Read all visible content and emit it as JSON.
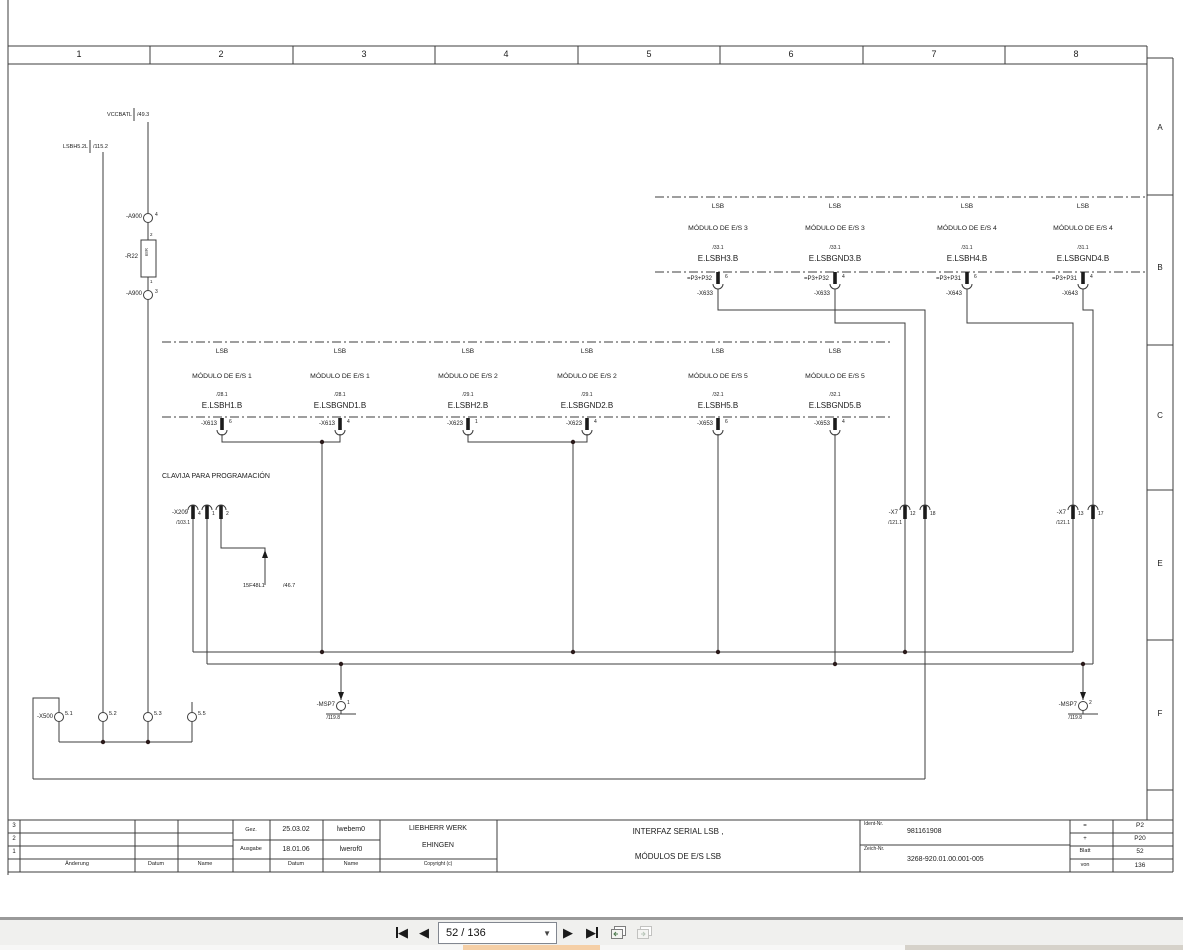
{
  "border": {
    "columns": [
      "1",
      "2",
      "3",
      "4",
      "5",
      "6",
      "7",
      "8"
    ],
    "rows": [
      "A",
      "B",
      "C",
      "E",
      "F"
    ]
  },
  "signals": {
    "vccbatl": {
      "name": "VCCBATL",
      "ref": "/49.3"
    },
    "lsbh52l": {
      "name": "LSBH5.2L",
      "ref": "/115.2"
    },
    "prog_ref": {
      "name": "15F48L1",
      "ref": "/46.7"
    }
  },
  "components": {
    "clavija_title": "CLAVIJA PARA PROGRAMACIÓN",
    "a900_top": {
      "label": "-A900",
      "pin": "4"
    },
    "a900_bottom": {
      "label": "-A900",
      "pin": "3"
    },
    "r22": {
      "label": "-R22",
      "value": "68R",
      "pin_top": "2",
      "pin_bottom": "1"
    },
    "x209": {
      "label": "-X209",
      "ref": "/103.1",
      "pins": [
        "4",
        "1",
        "2"
      ]
    },
    "x7_left": {
      "label": "-X7",
      "ref": "/121.1",
      "pins": [
        "12",
        "18"
      ]
    },
    "x7_right": {
      "label": "-X7",
      "ref": "/121.1",
      "pins": [
        "13",
        "17"
      ]
    },
    "msp7_left": {
      "label": "-MSP7",
      "pin": "1",
      "ref": "/119.8"
    },
    "msp7_right": {
      "label": "-MSP7",
      "pin": "2",
      "ref": "/119.8"
    },
    "x500": {
      "label": "-X500",
      "pins": [
        "5.1",
        "5.2",
        "5.3",
        "5.5"
      ]
    }
  },
  "modules_row1": [
    {
      "bus": "LSB",
      "name": "MÓDULO DE E/S  3",
      "ref": "/33.1",
      "signal": "E.LSBH3.B",
      "loc": "=P3+P32",
      "conn": "-X633",
      "pin": "6"
    },
    {
      "bus": "LSB",
      "name": "MÓDULO DE E/S  3",
      "ref": "/33.1",
      "signal": "E.LSBGND3.B",
      "loc": "=P3+P32",
      "conn": "-X633",
      "pin": "4"
    },
    {
      "bus": "LSB",
      "name": "MÓDULO DE E/S  4",
      "ref": "/31.1",
      "signal": "E.LSBH4.B",
      "loc": "=P3+P31",
      "conn": "-X643",
      "pin": "6"
    },
    {
      "bus": "LSB",
      "name": "MÓDULO DE E/S  4",
      "ref": "/31.1",
      "signal": "E.LSBGND4.B",
      "loc": "=P3+P31",
      "conn": "-X643",
      "pin": "4"
    }
  ],
  "modules_row2": [
    {
      "bus": "LSB",
      "name": "MÓDULO DE E/S  1",
      "ref": "/28.1",
      "signal": "E.LSBH1.B",
      "conn": "-X613",
      "pin": "6"
    },
    {
      "bus": "LSB",
      "name": "MÓDULO DE E/S  1",
      "ref": "/28.1",
      "signal": "E.LSBGND1.B",
      "conn": "-X613",
      "pin": "4"
    },
    {
      "bus": "LSB",
      "name": "MÓDULO DE E/S  2",
      "ref": "/29.1",
      "signal": "E.LSBH2.B",
      "conn": "-X623",
      "pin": "1"
    },
    {
      "bus": "LSB",
      "name": "MÓDULO DE E/S  2",
      "ref": "/29.1",
      "signal": "E.LSBGND2.B",
      "conn": "-X623",
      "pin": "4"
    },
    {
      "bus": "LSB",
      "name": "MÓDULO DE E/S 5",
      "ref": "/32.1",
      "signal": "E.LSBH5.B",
      "conn": "-X653",
      "pin": "6"
    },
    {
      "bus": "LSB",
      "name": "MÓDULO DE E/S 5",
      "ref": "/32.1",
      "signal": "E.LSBGND5.B",
      "conn": "-X653",
      "pin": "4"
    }
  ],
  "titleblock": {
    "rev_rows": [
      "3",
      "2",
      "1"
    ],
    "col_aenderung": "Änderung",
    "col_datum": "Datum",
    "col_name": "Name",
    "gez_label": "Gez.",
    "gez_date": "25.03.02",
    "gez_name": "lwebem0",
    "ausgabe_label": "Ausgabe",
    "ausgabe_date": "18.01.06",
    "ausgabe_name": "lwerof0",
    "datum_label": "Datum",
    "name_label": "Name",
    "company_line1": "LIEBHERR WERK",
    "company_line2": "EHINGEN",
    "copyright": "Copyright (c)",
    "title_line1": "INTERFAZ SERIAL LSB ,",
    "title_line2": "MÓDULOS DE E/S LSB",
    "ident_label": "Ident-Nr.",
    "ident_value": "981161908",
    "zeich_label": "Zeich-Nr.",
    "zeich_value": "3268-920.01.00.001-005",
    "eq_label": "=",
    "eq_value": "P2",
    "plus_label": "+",
    "plus_value": "P20",
    "blatt_label": "Blatt",
    "blatt_value": "52",
    "von_label": "von",
    "von_value": "136"
  },
  "viewer": {
    "page_field": "52 / 136"
  }
}
